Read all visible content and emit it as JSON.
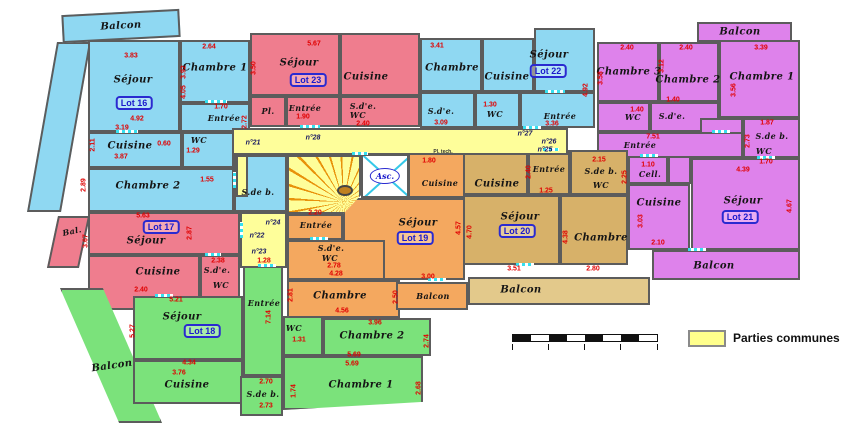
{
  "legend": {
    "label": "Parties communes"
  },
  "colors": {
    "cyan_lot": "#8FD8F2",
    "red_lot": "#EF7D8E",
    "magenta_lot": "#DE82EB",
    "orange_lot": "#F4A85F",
    "tan_lot": "#D7B169",
    "green_lot": "#7BE27B",
    "common_yellow": "#FEFE9A",
    "balcony_tan": "#E3C98B",
    "wall": "#5C5C5C",
    "dimension_red": "#E00000",
    "lot_badge_blue": "#1A1ACC",
    "door_cyan": "#35E0F0"
  },
  "lots": {
    "l16": "Lot 16",
    "l17": "Lot 17",
    "l18": "Lot 18",
    "l19": "Lot 19",
    "l20": "Lot 20",
    "l21": "Lot 21",
    "l22": "Lot 22",
    "l23": "Lot 23"
  },
  "common": {
    "elevator": "Asc.",
    "pl_tech": "Pl. tech.",
    "doors": {
      "n21": "n°21",
      "n28": "n°28",
      "n24": "n°24",
      "n22": "n°22",
      "n23": "n°23",
      "n27": "n°27",
      "n26": "n°26",
      "n25": "n°25"
    }
  },
  "rooms": {
    "l16_balcon": "Balcon",
    "l16_sejour": "Séjour",
    "l16_chambre1": "Chambre 1",
    "l16_entree": "Entrée",
    "l16_cuisine": "Cuisine",
    "l16_wc": "WC",
    "l16_chambre2": "Chambre 2",
    "l16_sdb": "S.de b.",
    "l23_sejour": "Séjour",
    "l23_cuisine": "Cuisine",
    "l23_pl": "Pl.",
    "l23_entree": "Entrée",
    "l23_sde": "S.d'e.",
    "l23_wc": "WC",
    "l22_chambre": "Chambre",
    "l22_sde": "S.d'e.",
    "l22_cuisine": "Cuisine",
    "l22_wc": "WC",
    "l22_sejour": "Séjour",
    "l22_entree": "Entrée",
    "l21_balcon_top": "Balcon",
    "l21_chambre3": "Chambre 3",
    "l21_chambre2": "Chambre 2",
    "l21_chambre1": "Chambre 1",
    "l21_wc": "WC",
    "l21_sde": "S.d'e.",
    "l21_entree": "Entrée",
    "l21_sdb": "S.de b.",
    "l21_sdb_wc": "WC",
    "l21_cell": "Cell.",
    "l21_cuisine": "Cuisine",
    "l21_sejour": "Séjour",
    "l21_balcon_bottom": "Balcon",
    "l20_cuisine": "Cuisine",
    "l20_entree": "Entrée",
    "l20_sdb": "S.de b.",
    "l20_wc": "WC",
    "l20_sejour": "Séjour",
    "l20_chambre": "Chambre",
    "l20_balcon": "Balcon",
    "l19_cuisine": "Cuisine",
    "l19_entree": "Entrée",
    "l19_sde": "S.d'e.",
    "l19_wc": "WC",
    "l19_sejour": "Séjour",
    "l19_chambre": "Chambre",
    "l19_balcon": "Balcon",
    "l17_sejour": "Séjour",
    "l17_bal": "Bal.",
    "l17_cuisine": "Cuisine",
    "l17_sde": "S.d'e.",
    "l17_wc": "WC",
    "l18_sejour": "Séjour",
    "l18_balcon": "Balcon",
    "l18_cuisine": "Cuisine",
    "l18_entree": "Entrée",
    "l18_wc": "WC",
    "l18_chambre2": "Chambre 2",
    "l18_chambre1": "Chambre 1",
    "l18_sdb": "S.de b."
  },
  "dims": {
    "d1": "3.83",
    "d2": "2.64",
    "d3": "3.92",
    "d4": "4.05",
    "d5": "1.70",
    "d6": "4.92",
    "d7": "3.19",
    "d8": "2.11",
    "d9": "0.60",
    "d10": "1.29",
    "d11": "3.87",
    "d12": "2.89",
    "d13": "1.55",
    "d14": "2.72",
    "d15": "5.67",
    "d16": "3.50",
    "d17": "1.90",
    "d18": "2.40",
    "d19": "3.41",
    "d20": "3.09",
    "d21": "1.30",
    "d22": "3.36",
    "d23": "4.92",
    "d24": "2.40",
    "d25": "2.40",
    "d26": "3.39",
    "d27": "3.58",
    "d28": "3.12",
    "d29": "3.56",
    "d30": "1.40",
    "d31": "1.40",
    "d32": "7.51",
    "d33": "1.87",
    "d34": "2.73",
    "d35": "1.70",
    "d36": "1.10",
    "d37": "3.03",
    "d38": "2.10",
    "d39": "4.39",
    "d40": "4.67",
    "d41": "2.15",
    "d42": "2.25",
    "d43": "1.25",
    "d44": "2.40",
    "d45": "3.51",
    "d46": "4.70",
    "d47": "4.38",
    "d48": "2.80",
    "d49": "1.80",
    "d50": "2.20",
    "d51": "2.78",
    "d52": "4.28",
    "d53": "3.00",
    "d54": "4.57",
    "d55": "4.56",
    "d56": "2.81",
    "d57": "2.50",
    "d58": "5.63",
    "d59": "2.87",
    "d60": "3.67",
    "d61": "2.40",
    "d62": "5.21",
    "d63": "2.38",
    "d64": "1.28",
    "d65": "4.34",
    "d66": "3.76",
    "d67": "5.27",
    "d68": "7.14",
    "d69": "1.31",
    "d70": "3.96",
    "d71": "5.69",
    "d72": "5.69",
    "d73": "2.74",
    "d74": "2.68",
    "d75": "2.70",
    "d76": "2.73",
    "d77": "1.74"
  }
}
